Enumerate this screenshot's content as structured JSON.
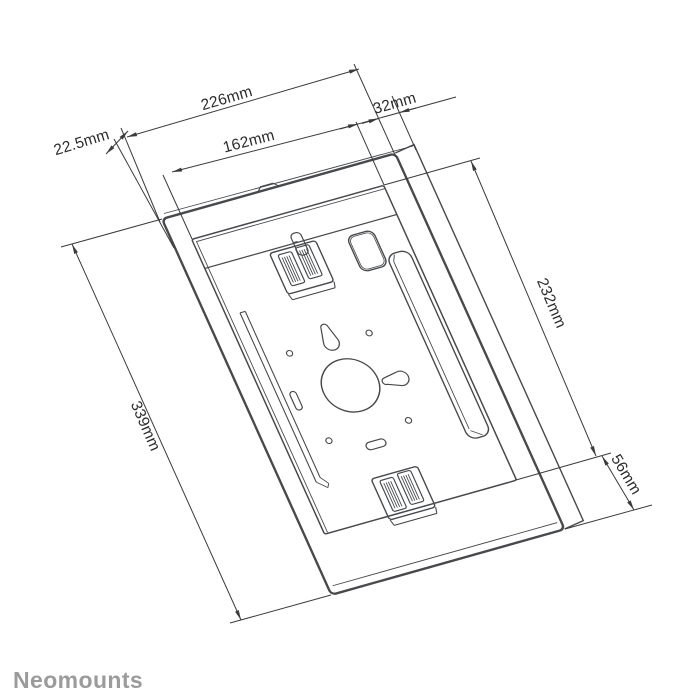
{
  "page": {
    "background": "#ffffff"
  },
  "branding": {
    "logo_text": "Neomounts",
    "logo_color": "#9b9b9b"
  },
  "drawing": {
    "line_color": "#47494c",
    "dimension_color": "#3b3b3b",
    "dimensions": {
      "outer_width": "226mm",
      "back_panel_offset": "32mm",
      "inner_width": "162mm",
      "top_lip": "22.5mm",
      "inner_height": "232mm",
      "outer_height": "339mm",
      "bottom_lip": "56mm"
    }
  }
}
